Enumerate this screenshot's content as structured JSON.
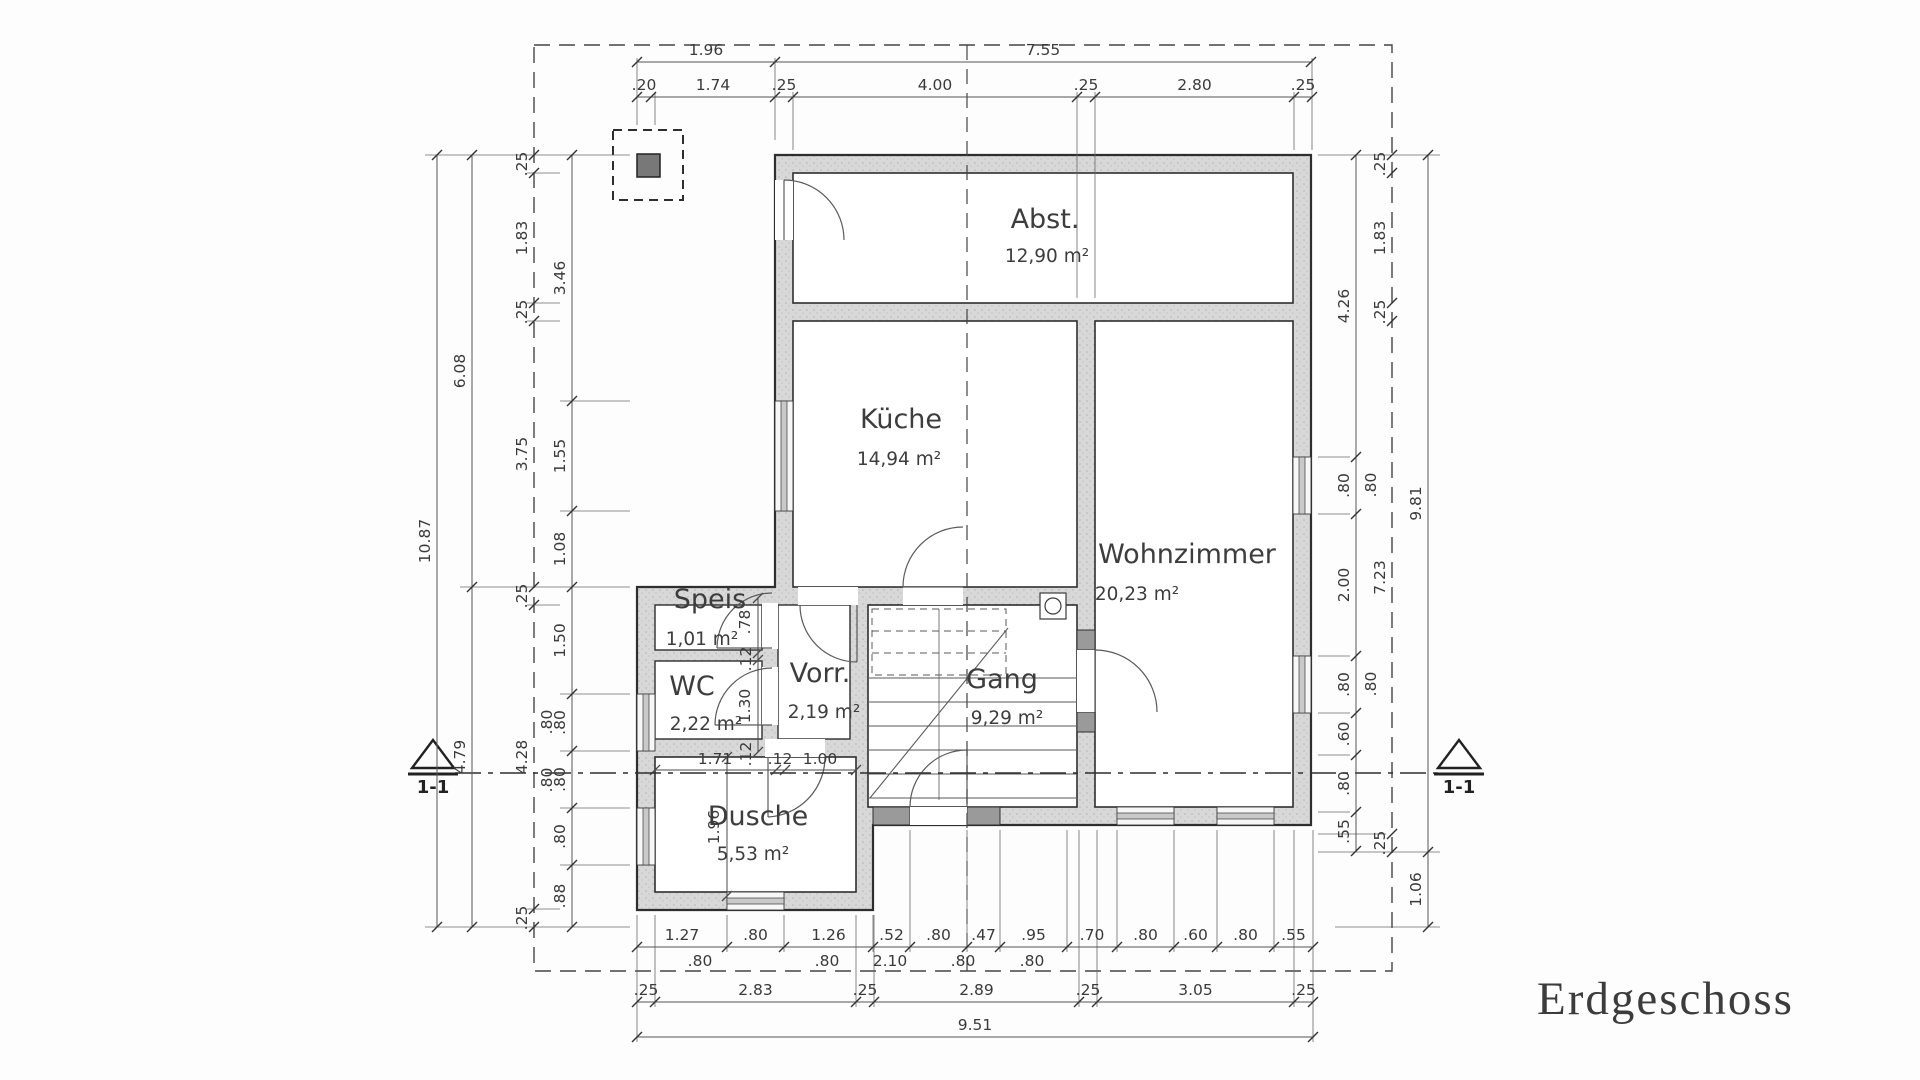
{
  "title": "Erdgeschoss",
  "section_marker": "1-1",
  "colors": {
    "paper": "#fdfdfd",
    "line": "#3a3a3a",
    "wall_fill": "#d6d6d6"
  },
  "rooms": [
    {
      "name": "Abst.",
      "area": "12,90 m²"
    },
    {
      "name": "Küche",
      "area": "14,94 m²"
    },
    {
      "name": "Wohnzimmer",
      "area": "20,23 m²"
    },
    {
      "name": "Speis",
      "area": "1,01 m²"
    },
    {
      "name": "WC",
      "area": "2,22 m²"
    },
    {
      "name": "Vorr.",
      "area": "2,19 m²"
    },
    {
      "name": "Gang",
      "area": "9,29 m²"
    },
    {
      "name": "Dusche",
      "area": "5,53 m²"
    }
  ],
  "dimensions": {
    "top_overall": [
      "1.96",
      "7.55"
    ],
    "top_detail": [
      ".20",
      "1.74",
      ".25",
      "4.00",
      ".25",
      "2.80",
      ".25"
    ],
    "left_overall": [
      "10.87"
    ],
    "left_mid": [
      "6.08",
      "4.79"
    ],
    "left_border": [
      ".25",
      "1.83",
      ".25",
      "3.75",
      ".25",
      "4.28",
      ".25"
    ],
    "left_inner": [
      "3.46",
      "1.55",
      "1.08",
      "1.50",
      ".80",
      ".80",
      ".80",
      ".88"
    ],
    "right_inner": [
      "4.26",
      ".80",
      "2.00",
      ".80",
      ".60",
      ".80",
      ".55"
    ],
    "right_border": [
      ".25",
      "1.83",
      ".25",
      "7.23",
      ".25"
    ],
    "right_overall": [
      "9.81",
      "1.06"
    ],
    "bottom_detail": [
      "1.27",
      ".80",
      "1.26",
      ".52",
      ".80",
      ".47",
      ".95",
      ".70",
      ".80",
      ".60",
      ".80",
      ".55"
    ],
    "bottom_axis": [
      ".80",
      ".80",
      "2.10",
      ".80",
      ".80"
    ],
    "bottom_mid": [
      ".25",
      "2.83",
      ".25",
      "2.89",
      ".25",
      "3.05",
      ".25"
    ],
    "bottom_overall": [
      "9.51"
    ],
    "interior": [
      "1.71",
      ".12",
      "1.00",
      "1.96",
      ".78",
      "1.30",
      ".12",
      ".12"
    ]
  }
}
